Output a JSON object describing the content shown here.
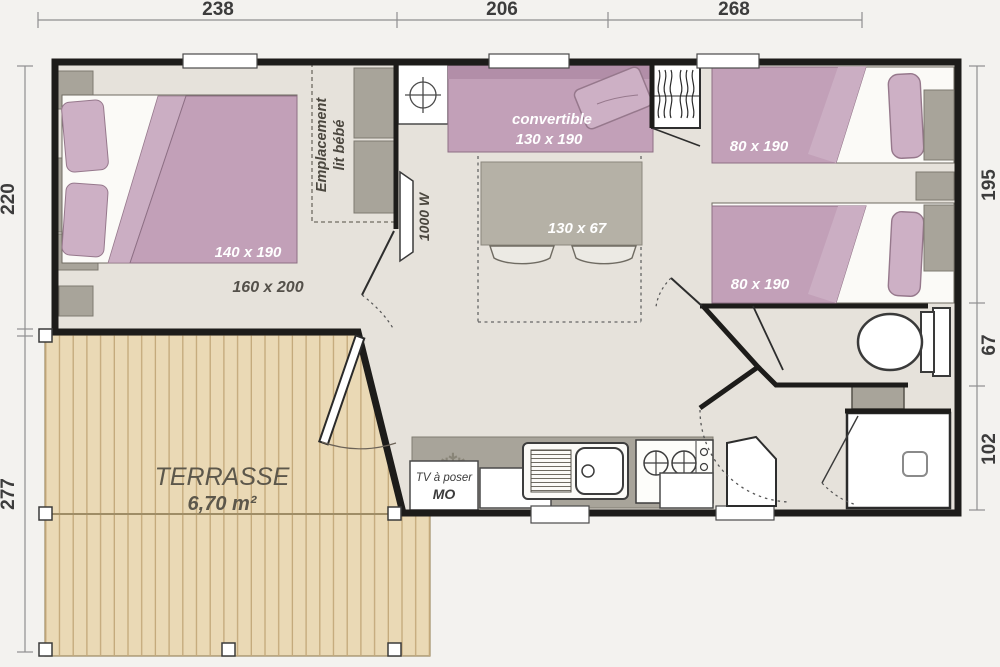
{
  "plan_type": "mobile-home floor plan",
  "dimensions": {
    "top": [
      "238",
      "206",
      "268"
    ],
    "left": [
      "220",
      "277"
    ],
    "right": [
      "195",
      "67",
      "102"
    ]
  },
  "labels": {
    "master_bed": "140 x 190",
    "master_room": "160 x 200",
    "baby_1": "Emplacement",
    "baby_2": "lit bébé",
    "heater": "1000 W",
    "sofa_1": "convertible",
    "sofa_2": "130 x 190",
    "table": "130 x 67",
    "twin_bed_1": "80 x 190",
    "twin_bed_2": "80 x 190",
    "tv_1": "TV à poser",
    "tv_2": "MO",
    "terrace_1": "TERRASSE",
    "terrace_2": "6,70 m²"
  },
  "colors": {
    "background": "#f3f2ef",
    "floor": "#e6e2db",
    "wall": "#1d1c1a",
    "bed_mauve": "#c2a0b8",
    "pillow_mauve": "#cdb0c5",
    "furniture_gray": "#a8a49a",
    "terrace_wood": "#ead9b5",
    "terrace_line": "#c3a87a",
    "dimension_text": "#3c3c3c"
  }
}
